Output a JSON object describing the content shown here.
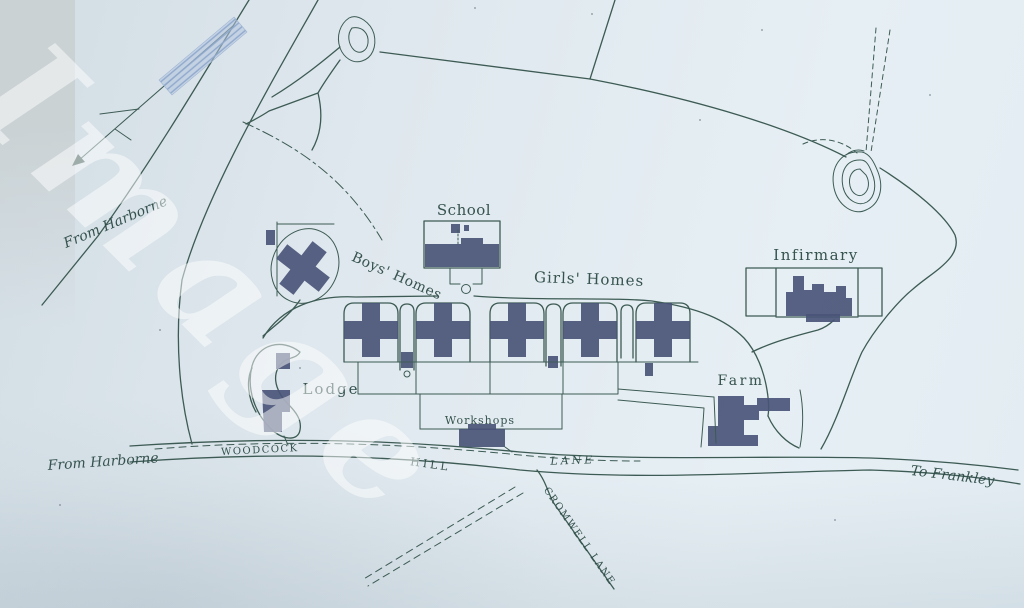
{
  "watermark": {
    "text": "Image"
  },
  "labels": {
    "school": "School",
    "boys_homes": "Boys' Homes",
    "girls_homes": "Girls' Homes",
    "infirmary": "Infirmary",
    "lodge": "Lodge",
    "farm": "Farm",
    "workshops": "Workshops",
    "from_harborne_upper": "From Harborne",
    "from_harborne_lower": "From Harborne",
    "road_woodcock": "WOODCOCK",
    "road_hill": "HILL",
    "road_lane": "LANE",
    "to_frankley": "To Frankley",
    "cromwell_lane": "CROMWELL LANE"
  },
  "colors": {
    "paper": "#dfe8ee",
    "paper_dark": "#d2dde4",
    "edge": "#c9d0d2",
    "ink": "#3d5b54",
    "text": "#2d4b46",
    "bldg": "#4a5578",
    "hatch": "#b3c4de",
    "wm": "#ffffff"
  }
}
